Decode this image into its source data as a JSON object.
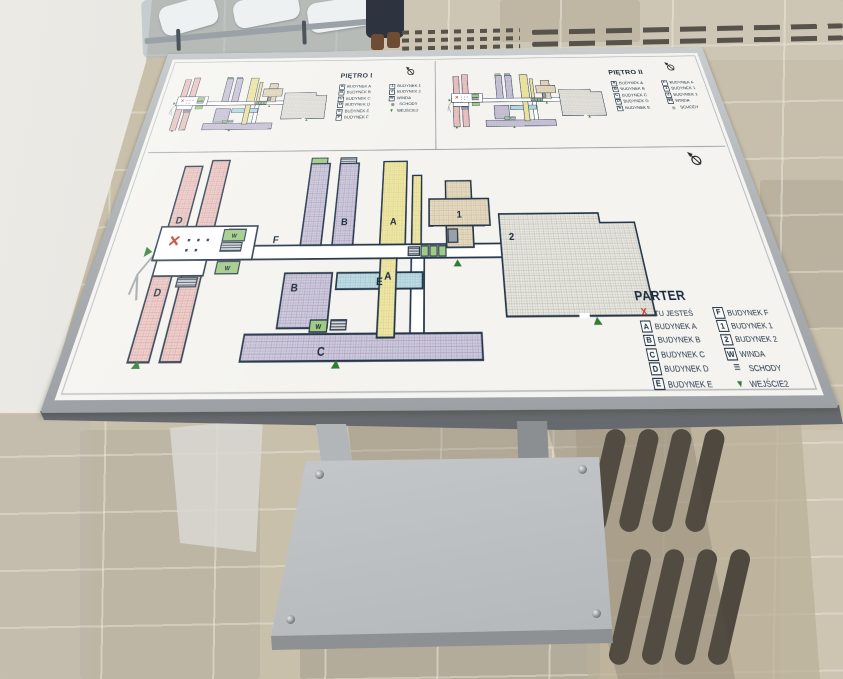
{
  "board": {
    "panels": {
      "pietro1": {
        "title": "PIĘTRO I",
        "legend_col1": [
          {
            "kind": "box",
            "symbol": "A",
            "label": "BUDYNEK A"
          },
          {
            "kind": "box",
            "symbol": "B",
            "label": "BUDYNEK B"
          },
          {
            "kind": "box",
            "symbol": "C",
            "label": "BUDYNEK C"
          },
          {
            "kind": "box",
            "symbol": "D",
            "label": "BUDYNEK D"
          },
          {
            "kind": "box",
            "symbol": "E",
            "label": "BUDYNEK E"
          },
          {
            "kind": "box",
            "symbol": "F",
            "label": "BUDYNEK F"
          }
        ],
        "legend_col2": [
          {
            "kind": "box",
            "symbol": "1",
            "label": "BUDYNEK 1"
          },
          {
            "kind": "box",
            "symbol": "2",
            "label": "BUDYNEK 2"
          },
          {
            "kind": "box",
            "symbol": "W",
            "label": "WINDA"
          },
          {
            "kind": "stairs",
            "symbol": "≡",
            "label": "SCHODY"
          },
          {
            "kind": "entrance",
            "symbol": "▼",
            "label": "WEJŚCIE2"
          }
        ]
      },
      "pietro2": {
        "title": "PIĘTRO II",
        "legend_col1": [
          {
            "kind": "box",
            "symbol": "A",
            "label": "BUDYNEK A"
          },
          {
            "kind": "box",
            "symbol": "B",
            "label": "BUDYNEK B"
          },
          {
            "kind": "box",
            "symbol": "C",
            "label": "BUDYNEK C"
          },
          {
            "kind": "box",
            "symbol": "D",
            "label": "BUDYNEK D"
          },
          {
            "kind": "box",
            "symbol": "E",
            "label": "BUDYNEK E"
          }
        ],
        "legend_col2": [
          {
            "kind": "box",
            "symbol": "F",
            "label": "BUDYNEK F"
          },
          {
            "kind": "box",
            "symbol": "1",
            "label": "BUDYNEK 1"
          },
          {
            "kind": "box",
            "symbol": "2",
            "label": "BUDYNEK 2"
          },
          {
            "kind": "box",
            "symbol": "W",
            "label": "WINDA"
          },
          {
            "kind": "stairs",
            "symbol": "≡",
            "label": "SCHODY"
          }
        ]
      },
      "parter": {
        "title": "PARTER",
        "legend_col1": [
          {
            "kind": "x",
            "symbol": "X",
            "label": "TU JESTEŚ"
          },
          {
            "kind": "box",
            "symbol": "A",
            "label": "BUDYNEK A"
          },
          {
            "kind": "box",
            "symbol": "B",
            "label": "BUDYNEK B"
          },
          {
            "kind": "box",
            "symbol": "C",
            "label": "BUDYNEK C"
          },
          {
            "kind": "box",
            "symbol": "D",
            "label": "BUDYNEK D"
          },
          {
            "kind": "box",
            "symbol": "E",
            "label": "BUDYNEK E"
          }
        ],
        "legend_col2": [
          {
            "kind": "box",
            "symbol": "F",
            "label": "BUDYNEK F"
          },
          {
            "kind": "box",
            "symbol": "1",
            "label": "BUDYNEK 1"
          },
          {
            "kind": "box",
            "symbol": "2",
            "label": "BUDYNEK 2"
          },
          {
            "kind": "box",
            "symbol": "W",
            "label": "WINDA"
          },
          {
            "kind": "stairs",
            "symbol": "≡",
            "label": "SCHODY"
          },
          {
            "kind": "entrance",
            "symbol": "▼",
            "label": "WEJŚCIE2"
          }
        ]
      }
    },
    "map_labels": {
      "building_a": "A",
      "building_b": "B",
      "building_c": "C",
      "building_d": "D",
      "building_e": "E",
      "building_f": "F",
      "building_1": "1",
      "building_2": "2",
      "winda": "W"
    },
    "colors": {
      "you_are_here_red": "#c0392b",
      "entrance_green": "#2e7d32",
      "winda_green": "#9fcb84",
      "building_a_yellow": "#efe8a6",
      "building_b_purple": "#d0cbdc",
      "building_d_pink": "#eccbc8",
      "building_e_blue": "#c0dde4",
      "building_1_beige": "#e6dcc4",
      "outline_navy": "#26374a",
      "frame_silver": "#b9bdc1"
    }
  }
}
